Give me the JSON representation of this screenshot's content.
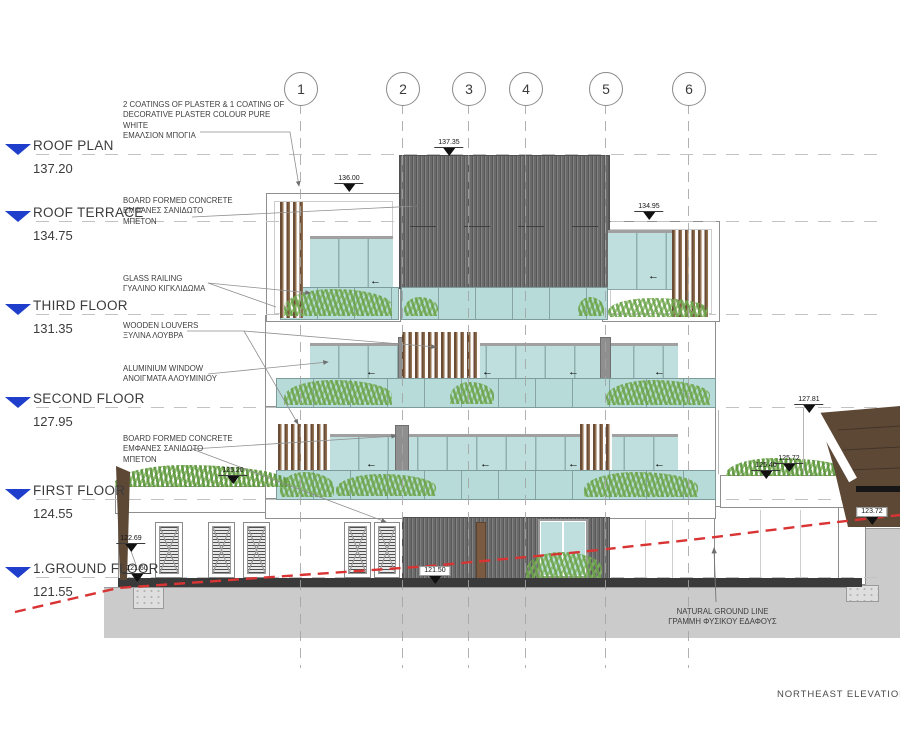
{
  "title_block": {
    "label": "NORTHEAST ELEVATION"
  },
  "grid": {
    "bubbles": [
      "1",
      "2",
      "3",
      "4",
      "5",
      "6"
    ]
  },
  "levels": [
    {
      "name": "ROOF PLAN",
      "elevation": "137.20"
    },
    {
      "name": "ROOF TERRACE",
      "elevation": "134.75"
    },
    {
      "name": "THIRD FLOOR",
      "elevation": "131.35"
    },
    {
      "name": "SECOND FLOOR",
      "elevation": "127.95"
    },
    {
      "name": "FIRST FLOOR",
      "elevation": "124.55"
    },
    {
      "name": "1.GROUND FLOOR",
      "elevation": "121.55"
    }
  ],
  "annotations": {
    "plaster": [
      "2 COATINGS OF PLASTER & 1 COATING OF",
      "DECORATIVE PLASTER COLOUR PURE",
      "WHITE",
      "ΕΜΑΛΣΙΟΝ ΜΠΟΓΙΑ"
    ],
    "concrete_upper": [
      "BOARD FORMED CONCRETE",
      "ΕΜΦΑΝΕΣ ΣΑΝΙΔΩΤΟ",
      "ΜΠΕΤΟΝ"
    ],
    "glass_railing": [
      "GLASS RAILING",
      "ΓΥΑΛΙΝΟ ΚΙΓΚΛΙΔΩΜΑ"
    ],
    "wooden_louvers": [
      "WOODEN LOUVERS",
      "ΞΥΛΙΝΑ ΛΟΥΒΡΑ"
    ],
    "aluminium_window": [
      "ALUMINIUM WINDOW",
      "ΑΝΟΙΓΜΑΤΑ ΑΛΟΥΜΙΝΙΟΥ"
    ],
    "concrete_lower": [
      "BOARD FORMED CONCRETE",
      "ΕΜΦΑΝΕΣ ΣΑΝΙΔΩΤΟ",
      "ΜΠΕΤΟΝ"
    ],
    "natural_ground": [
      "NATURAL GROUND LINE",
      "ΓΡΑΜΜΗ ΦΥΣΙΚΟΥ ΕΔΑΦΟΥΣ"
    ]
  },
  "spot_elevations": {
    "roof_top": "137.35",
    "penthouse_left": "136.00",
    "penthouse_right": "134.95",
    "slope_top": "127.81",
    "planter_high": "125.72",
    "planter_low": "125.40",
    "wing_roof": "125.20",
    "wall_right": "123.72",
    "wing_mid": "122.69",
    "ground_left": "121.60",
    "ground_slab": "121.50"
  },
  "colors": {
    "level_blue": "#1e3ecb",
    "ground_red": "#d93434",
    "glass": "#bedfde",
    "railing": "#b7dbd9",
    "louver": "#8a684a",
    "earth": "#5d4836",
    "cladding": "#6f6f6f",
    "ground": "#cbcbcb",
    "foliage": "#74a855",
    "line": "#8f8f8f"
  }
}
